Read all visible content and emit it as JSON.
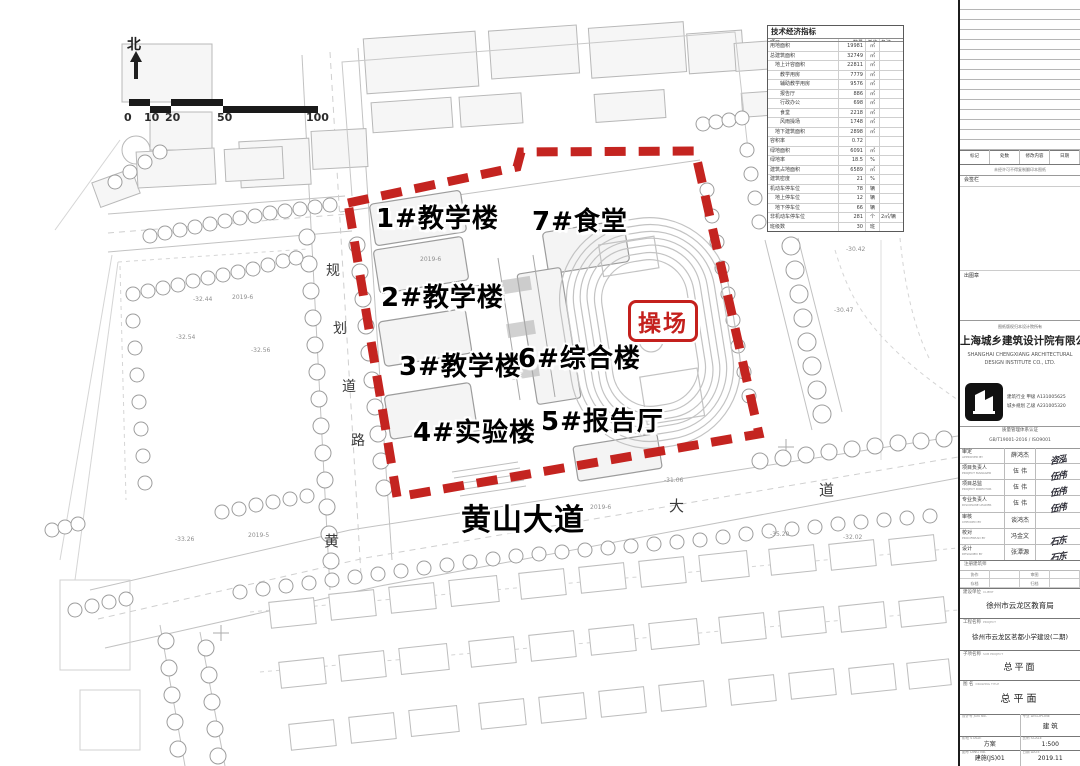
{
  "colors": {
    "boundary": "#c42420",
    "playground": "#c4201d",
    "label": "#000000"
  },
  "map": {
    "north": "北",
    "scale_ticks": [
      "0",
      "10",
      "20",
      "50",
      "100"
    ],
    "left_road_chars": [
      "规",
      "划",
      "道",
      "路"
    ],
    "avenue_chars": [
      "黄",
      "大",
      "道"
    ],
    "labels": {
      "b1": "1#教学楼",
      "b2": "2#教学楼",
      "b3": "3#教学楼",
      "b4": "4#实验楼",
      "b5": "5#报告厅",
      "b6": "6#综合楼",
      "b7": "7#食堂",
      "playground": "操场",
      "avenue": "黄山大道"
    },
    "annotations": [
      "-32.44",
      "2019-6",
      "-32.54",
      "-32.56",
      "2019-5",
      "-33.26",
      "2019-6",
      "-31.06",
      "-35.20",
      "-32.02",
      "-30.42",
      "-30.47",
      "2019-6"
    ]
  },
  "indicators": {
    "title": "技术经济指标",
    "headers": [
      "项目",
      "数量",
      "单位",
      "备注"
    ],
    "rows": [
      {
        "label": "用地面积",
        "value": "19981",
        "unit": "㎡",
        "note": ""
      },
      {
        "label": "总建筑面积",
        "value": "32749",
        "unit": "㎡",
        "note": ""
      },
      {
        "label": "　地上计容面积",
        "value": "22811",
        "unit": "㎡",
        "note": ""
      },
      {
        "label": "　　教学用房",
        "value": "7779",
        "unit": "㎡",
        "note": ""
      },
      {
        "label": "　　辅助教学用房",
        "value": "9576",
        "unit": "㎡",
        "note": ""
      },
      {
        "label": "　　报告厅",
        "value": "886",
        "unit": "㎡",
        "note": ""
      },
      {
        "label": "　　行政办公",
        "value": "698",
        "unit": "㎡",
        "note": ""
      },
      {
        "label": "　　食堂",
        "value": "2218",
        "unit": "㎡",
        "note": ""
      },
      {
        "label": "　　风雨操场",
        "value": "1748",
        "unit": "㎡",
        "note": ""
      },
      {
        "label": "　地下建筑面积",
        "value": "2898",
        "unit": "㎡",
        "note": ""
      },
      {
        "label": "容积率",
        "value": "0.72",
        "unit": "",
        "note": ""
      },
      {
        "label": "绿地面积",
        "value": "6091",
        "unit": "㎡",
        "note": ""
      },
      {
        "label": "绿地率",
        "value": "18.5",
        "unit": "%",
        "note": ""
      },
      {
        "label": "建筑占地面积",
        "value": "6589",
        "unit": "㎡",
        "note": ""
      },
      {
        "label": "建筑密度",
        "value": "21",
        "unit": "%",
        "note": ""
      },
      {
        "label": "机动车停车位",
        "value": "78",
        "unit": "辆",
        "note": ""
      },
      {
        "label": "　地上停车位",
        "value": "12",
        "unit": "辆",
        "note": ""
      },
      {
        "label": "　地下停车位",
        "value": "66",
        "unit": "辆",
        "note": ""
      },
      {
        "label": "非机动车停车位",
        "value": "281",
        "unit": "个",
        "note": "2㎡/辆"
      },
      {
        "label": "班级数",
        "value": "30",
        "unit": "班",
        "note": ""
      }
    ]
  },
  "titleblock": {
    "revision_header": [
      "标记",
      "处数",
      "修改内容",
      "日期"
    ],
    "note": "未经许可不得复制翻印本图纸",
    "coop_label": "会签栏",
    "seal_label": "出图章",
    "caption": "图纸版权归本设计院所有",
    "company_cn": "上海城乡建筑设计院有限公司",
    "company_en": "SHANGHAI CHENGXIANG ARCHITECTURAL DESIGN INSTITUTE CO., LTD.",
    "cert1": "建筑行业 甲级 A131005625",
    "cert2": "城乡规划 乙级 A231005320",
    "iso1": "质量管理体系认证",
    "iso2": "GB/T19001-2016 / ISO9001",
    "signatures": [
      {
        "role": "审定",
        "en": "APPROVED BY",
        "name": "薛鸿杰",
        "sig": "咨泓"
      },
      {
        "role": "项目负责人",
        "en": "PROJECT MANAGER",
        "name": "伍 伟",
        "sig": "伍伟"
      },
      {
        "role": "项目总监",
        "en": "PROJECT DIRECTOR",
        "name": "伍 伟",
        "sig": "伍伟"
      },
      {
        "role": "专业负责人",
        "en": "DISCIPLINE LEADER",
        "name": "伍 伟",
        "sig": "伍伟"
      },
      {
        "role": "审核",
        "en": "CHECKED BY",
        "name": "谈鸿杰",
        "sig": ""
      },
      {
        "role": "校对",
        "en": "PROOFREAD BY",
        "name": "冯金文",
        "sig": "石东"
      },
      {
        "role": "设计",
        "en": "DESIGNED BY",
        "name": "张潭源",
        "sig": "石东"
      }
    ],
    "reg_label": "注册建筑师",
    "small_cells": [
      "协作",
      "",
      "审图",
      "",
      "存档",
      "",
      "归档",
      ""
    ],
    "client_label": "建设单位",
    "client_en": "CLIENT",
    "client": "徐州市云龙区教育局",
    "project_label": "工程名称",
    "project_en": "PROJECT",
    "project": "徐州市云龙区茗都小学建设(二期)",
    "subject_label": "子项名称",
    "subject_en": "SUB PROJECT",
    "subject": "总平面",
    "drawing_label": "图 名",
    "drawing_en": "DRAWING TITLE",
    "drawing": "总平面",
    "job_label": "设计号",
    "job_en": "JOB No.",
    "job": "",
    "disc_label": "专业",
    "disc_en": "DISCIPLINE",
    "disc": "建 筑",
    "stage_label": "阶段",
    "stage_en": "STAGE",
    "stage": "方案",
    "scale_label": "比例",
    "scale_en": "SCALE",
    "scale": "1:500",
    "dwg_label": "图号",
    "dwg_en": "DWG No.",
    "dwg": "建施(JS)01",
    "date_label": "日期",
    "date_en": "DATE",
    "date": "2019.11"
  }
}
